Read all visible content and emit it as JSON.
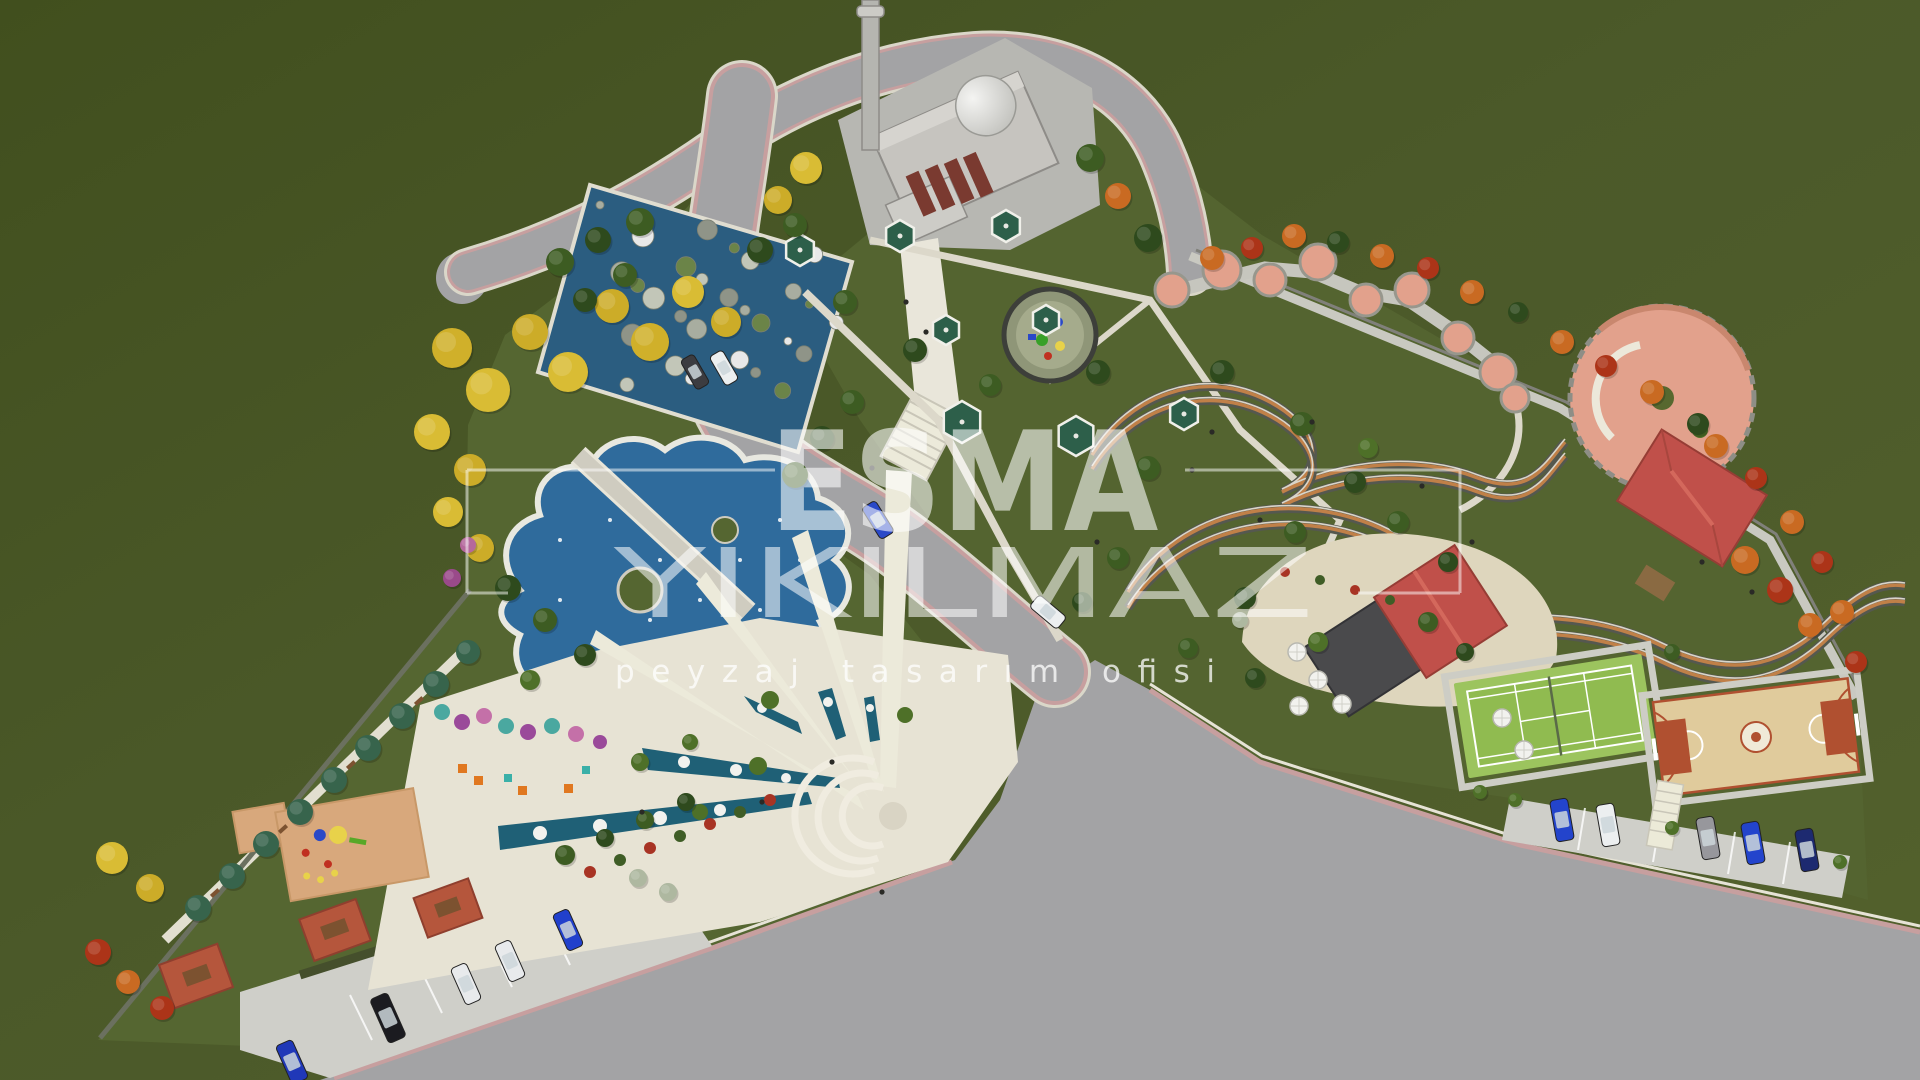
{
  "meta": {
    "title": "Park landscape masterplan – aerial 3D render"
  },
  "watermark": {
    "line1": "ESMA",
    "line2": "YIKILMAZ",
    "tagline": "peyzaj tasarım ofisi",
    "color": "#ffffff"
  },
  "palette": {
    "field_green": "#4b5929",
    "park_green": "#556631",
    "asphalt": "#a3a3a5",
    "road_stripe_pink": "#c79f9f",
    "curb": "#dad7c9",
    "path": "#e6e2d3",
    "water": "#2f6b9c",
    "water_dark": "#2b5d80",
    "plaza_cream": "#e7e3d4",
    "sand": "#ded6bd",
    "salmon": "#e2a18c",
    "roof_red": "#c0504a",
    "roof_dark": "#4a4a4c",
    "tennis_green": "#9cc45e",
    "basketball_tan": "#e0cb9c",
    "court_red": "#b05030",
    "gazebo_green": "#2d5f4a",
    "mosque_grey": "#c6c4bf",
    "playground_tan": "#d8a87c",
    "picnic_red": "#b5563c",
    "mosaic_blue": "#1f6076"
  },
  "features": [
    "mosque with minaret and dome",
    "curved access roads with rose edge stripes",
    "rock cascade pool",
    "organic ornamental ponds with timber bridge",
    "fan-shaped mosaic plaza with amphitheater",
    "children playground",
    "picnic terraces",
    "gazebo garden",
    "circular play pad",
    "scalloped terrace walk",
    "terraced serpentine gardens",
    "circular terrace plaza",
    "red-roof pavilion",
    "cafe terrace with umbrellas",
    "tennis court",
    "basketball court",
    "street parking with cars",
    "perimeter tree planting"
  ],
  "trees": [
    [
      452,
      348,
      20,
      "#d0b02a"
    ],
    [
      488,
      390,
      22,
      "#d9bc34"
    ],
    [
      530,
      332,
      18,
      "#ccac28"
    ],
    [
      568,
      372,
      20,
      "#d9bc34"
    ],
    [
      612,
      306,
      17,
      "#ccac28"
    ],
    [
      650,
      342,
      19,
      "#d0b02a"
    ],
    [
      688,
      292,
      16,
      "#d9bc34"
    ],
    [
      726,
      322,
      15,
      "#ccac28"
    ],
    [
      432,
      432,
      18,
      "#d9bc34"
    ],
    [
      470,
      470,
      16,
      "#ccac28"
    ],
    [
      448,
      512,
      15,
      "#d9bc34"
    ],
    [
      480,
      548,
      14,
      "#ccac28"
    ],
    [
      560,
      262,
      14,
      "#3d5c22"
    ],
    [
      598,
      240,
      13,
      "#2e4a1d"
    ],
    [
      640,
      222,
      14,
      "#3d5c22"
    ],
    [
      585,
      300,
      12,
      "#2e4a1d"
    ],
    [
      625,
      275,
      12,
      "#3d5c22"
    ],
    [
      760,
      250,
      13,
      "#2e4a1d"
    ],
    [
      795,
      225,
      12,
      "#3d5c22"
    ],
    [
      806,
      168,
      16,
      "#d9bc34"
    ],
    [
      778,
      200,
      14,
      "#ccac28"
    ],
    [
      1090,
      158,
      14,
      "#3d5c22"
    ],
    [
      1118,
      196,
      13,
      "#c96a22"
    ],
    [
      1148,
      238,
      14,
      "#2e4a1d"
    ],
    [
      795,
      475,
      13,
      "#3d5c22"
    ],
    [
      822,
      438,
      12,
      "#2e4a1d"
    ],
    [
      852,
      402,
      12,
      "#3d5c22"
    ],
    [
      468,
      545,
      8,
      "#b5689c"
    ],
    [
      452,
      578,
      9,
      "#9a4a8a"
    ],
    [
      198,
      908,
      13,
      "#37644c"
    ],
    [
      232,
      876,
      13,
      "#37644c"
    ],
    [
      266,
      844,
      13,
      "#37644c"
    ],
    [
      300,
      812,
      13,
      "#37644c"
    ],
    [
      334,
      780,
      13,
      "#37644c"
    ],
    [
      368,
      748,
      13,
      "#37644c"
    ],
    [
      402,
      716,
      13,
      "#37644c"
    ],
    [
      436,
      684,
      13,
      "#37644c"
    ],
    [
      468,
      652,
      12,
      "#37644c"
    ],
    [
      112,
      858,
      16,
      "#d9bc34"
    ],
    [
      150,
      888,
      14,
      "#ccac28"
    ],
    [
      98,
      952,
      13,
      "#ac3418"
    ],
    [
      128,
      982,
      12,
      "#c96a22"
    ],
    [
      162,
      1008,
      12,
      "#ac3418"
    ],
    [
      508,
      588,
      13,
      "#2e4a1d"
    ],
    [
      545,
      620,
      12,
      "#3d5c22"
    ],
    [
      585,
      655,
      11,
      "#2e4a1d"
    ],
    [
      530,
      680,
      10,
      "#4e7028"
    ],
    [
      640,
      762,
      9,
      "#4e7028"
    ],
    [
      690,
      742,
      8,
      "#4e7028"
    ],
    [
      565,
      855,
      10,
      "#3d5c22"
    ],
    [
      605,
      838,
      9,
      "#2e4a1d"
    ],
    [
      645,
      820,
      9,
      "#3d5c22"
    ],
    [
      686,
      802,
      9,
      "#2e4a1d"
    ],
    [
      845,
      302,
      12,
      "#3d5c22"
    ],
    [
      915,
      350,
      12,
      "#2e4a1d"
    ],
    [
      990,
      385,
      11,
      "#3d5c22"
    ],
    [
      1098,
      372,
      12,
      "#2e4a1d"
    ],
    [
      1148,
      468,
      12,
      "#3d5c22"
    ],
    [
      1222,
      372,
      12,
      "#2e4a1d"
    ],
    [
      1302,
      424,
      12,
      "#3d5c22"
    ],
    [
      1355,
      482,
      11,
      "#2e4a1d"
    ],
    [
      1295,
      532,
      11,
      "#3d5c22"
    ],
    [
      1245,
      598,
      11,
      "#2e4a1d"
    ],
    [
      1398,
      522,
      11,
      "#3d5c22"
    ],
    [
      1448,
      562,
      10,
      "#2e4a1d"
    ],
    [
      1118,
      558,
      11,
      "#3d5c22"
    ],
    [
      1082,
      602,
      10,
      "#2e4a1d"
    ],
    [
      1188,
      648,
      10,
      "#3d5c22"
    ],
    [
      1255,
      678,
      10,
      "#2e4a1d"
    ],
    [
      1318,
      642,
      10,
      "#4e7028"
    ],
    [
      1368,
      448,
      10,
      "#4e7028"
    ],
    [
      1212,
      258,
      12,
      "#c96a22"
    ],
    [
      1252,
      248,
      11,
      "#ac3418"
    ],
    [
      1294,
      236,
      12,
      "#c96a22"
    ],
    [
      1338,
      242,
      11,
      "#2e4a1d"
    ],
    [
      1382,
      256,
      12,
      "#c96a22"
    ],
    [
      1428,
      268,
      11,
      "#ac3418"
    ],
    [
      1472,
      292,
      12,
      "#c96a22"
    ],
    [
      1518,
      312,
      10,
      "#2e4a1d"
    ],
    [
      1562,
      342,
      12,
      "#c96a22"
    ],
    [
      1606,
      366,
      11,
      "#ac3418"
    ],
    [
      1652,
      392,
      12,
      "#c96a22"
    ],
    [
      1698,
      424,
      11,
      "#2e4a1d"
    ],
    [
      1716,
      446,
      12,
      "#c96a22"
    ],
    [
      1756,
      478,
      11,
      "#ac3418"
    ],
    [
      1792,
      522,
      12,
      "#c96a22"
    ],
    [
      1822,
      562,
      11,
      "#ac3418"
    ],
    [
      1842,
      612,
      12,
      "#c96a22"
    ],
    [
      1856,
      662,
      11,
      "#ac3418"
    ],
    [
      1745,
      560,
      14,
      "#c96a22"
    ],
    [
      1780,
      590,
      13,
      "#ac3418"
    ],
    [
      1810,
      625,
      12,
      "#c96a22"
    ],
    [
      1428,
      622,
      10,
      "#3d5c22"
    ],
    [
      1465,
      652,
      9,
      "#2e4a1d"
    ],
    [
      1672,
      652,
      8,
      "#3d5c22"
    ],
    [
      1480,
      792,
      7,
      "#4e7028"
    ],
    [
      1515,
      800,
      7,
      "#4e7028"
    ],
    [
      1672,
      828,
      7,
      "#4e7028"
    ],
    [
      1840,
      862,
      7,
      "#4e7028"
    ],
    [
      638,
      878,
      9,
      "#aeb8a0"
    ],
    [
      668,
      892,
      9,
      "#aeb8a0"
    ],
    [
      1240,
      620,
      8,
      "#aeb8a0"
    ]
  ],
  "bushes": [
    [
      590,
      872,
      6,
      "#a83424"
    ],
    [
      620,
      860,
      6,
      "#3f5d26"
    ],
    [
      650,
      848,
      6,
      "#a83424"
    ],
    [
      680,
      836,
      6,
      "#3f5d26"
    ],
    [
      710,
      824,
      6,
      "#a83424"
    ],
    [
      740,
      812,
      6,
      "#3f5d26"
    ],
    [
      770,
      800,
      6,
      "#a83424"
    ],
    [
      1285,
      572,
      5,
      "#a83424"
    ],
    [
      1320,
      580,
      5,
      "#3f5d26"
    ],
    [
      1355,
      590,
      5,
      "#a83424"
    ],
    [
      1390,
      600,
      5,
      "#3f5d26"
    ]
  ],
  "cars": [
    {
      "x": 695,
      "y": 372,
      "a": 60,
      "c": "#3c3c40",
      "l": 34,
      "w": 15
    },
    {
      "x": 724,
      "y": 368,
      "a": 60,
      "c": "#eceff0",
      "l": 34,
      "w": 15
    },
    {
      "x": 878,
      "y": 520,
      "a": 58,
      "c": "#2a49c8",
      "l": 37,
      "w": 16
    },
    {
      "x": 1048,
      "y": 612,
      "a": 40,
      "c": "#eceff0",
      "l": 36,
      "w": 16
    },
    {
      "x": 292,
      "y": 1062,
      "a": 66,
      "c": "#2038b8",
      "l": 42,
      "w": 18
    },
    {
      "x": 388,
      "y": 1018,
      "a": 66,
      "c": "#1b1b20",
      "l": 48,
      "w": 19
    },
    {
      "x": 466,
      "y": 984,
      "a": 66,
      "c": "#e8eaec",
      "l": 40,
      "w": 17
    },
    {
      "x": 510,
      "y": 961,
      "a": 66,
      "c": "#e8eaec",
      "l": 40,
      "w": 17
    },
    {
      "x": 568,
      "y": 930,
      "a": 66,
      "c": "#2140cc",
      "l": 40,
      "w": 17
    },
    {
      "x": 1562,
      "y": 820,
      "a": 80,
      "c": "#2344cc",
      "l": 42,
      "w": 18
    },
    {
      "x": 1608,
      "y": 825,
      "a": 80,
      "c": "#eceff0",
      "l": 42,
      "w": 18
    },
    {
      "x": 1708,
      "y": 838,
      "a": 80,
      "c": "#97979c",
      "l": 42,
      "w": 18
    },
    {
      "x": 1753,
      "y": 843,
      "a": 80,
      "c": "#2344cc",
      "l": 42,
      "w": 18
    },
    {
      "x": 1807,
      "y": 850,
      "a": 80,
      "c": "#1d2a70",
      "l": 42,
      "w": 18
    }
  ],
  "gazebos": [
    [
      800,
      250,
      16
    ],
    [
      900,
      236,
      16
    ],
    [
      1006,
      226,
      16
    ],
    [
      946,
      330,
      15
    ],
    [
      1046,
      320,
      15
    ],
    [
      962,
      422,
      21
    ],
    [
      1076,
      436,
      20
    ],
    [
      1184,
      414,
      16
    ]
  ],
  "umbrellas": [
    [
      1297,
      652
    ],
    [
      1318,
      680
    ],
    [
      1299,
      706
    ],
    [
      1342,
      704
    ],
    [
      1502,
      718
    ],
    [
      1524,
      750
    ]
  ],
  "people": [
    [
      906,
      302
    ],
    [
      926,
      332
    ],
    [
      872,
      468
    ],
    [
      1097,
      542
    ],
    [
      1212,
      432
    ],
    [
      1312,
      422
    ],
    [
      1422,
      486
    ],
    [
      1472,
      542
    ],
    [
      762,
      802
    ],
    [
      832,
      762
    ],
    [
      642,
      812
    ],
    [
      1702,
      562
    ],
    [
      1752,
      592
    ],
    [
      882,
      892
    ],
    [
      1192,
      470
    ],
    [
      1260,
      520
    ]
  ],
  "benches": [
    [
      215,
      893,
      -42
    ],
    [
      283,
      829,
      -42
    ],
    [
      351,
      765,
      -42
    ],
    [
      419,
      701,
      -42
    ]
  ]
}
